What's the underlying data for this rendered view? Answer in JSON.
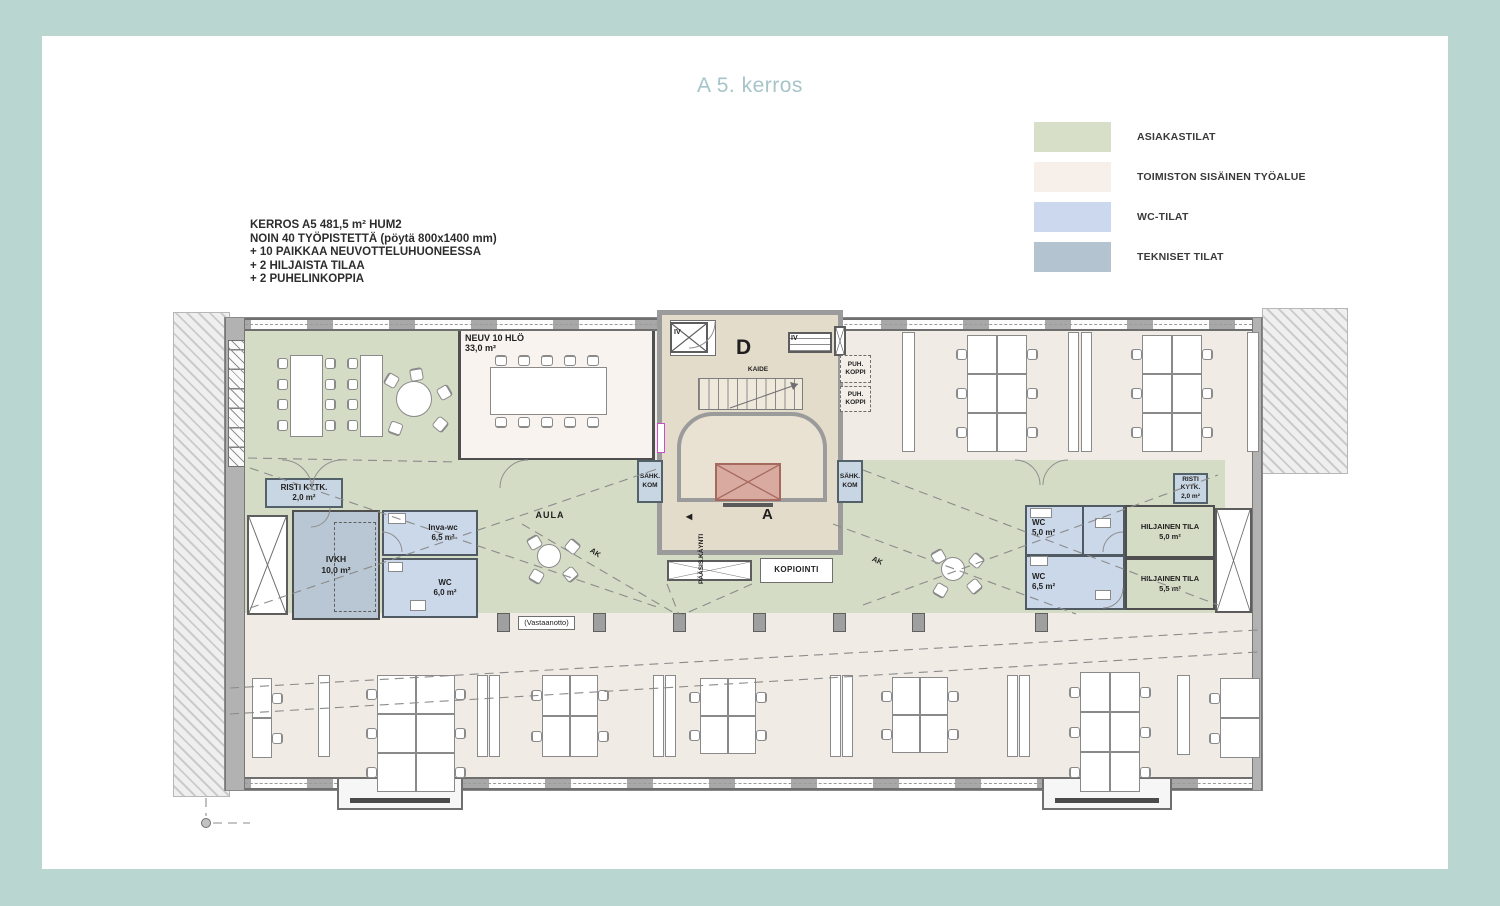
{
  "page": {
    "title": "A 5. kerros",
    "background_color": "#b9d6d0",
    "card_color": "#ffffff",
    "title_color": "#a6c4c9"
  },
  "legend": {
    "items": [
      {
        "label": "ASIAKASTILAT",
        "color": "#d7dfc9"
      },
      {
        "label": "TOIMISTON SISÄINEN TYÖALUE",
        "color": "#f7f0ea"
      },
      {
        "label": "WC-TILAT",
        "color": "#ccd8ed"
      },
      {
        "label": "TEKNISET TILAT",
        "color": "#b3c4d0"
      }
    ]
  },
  "info": {
    "lines": [
      "KERROS A5 481,5 m² HUM2",
      "NOIN 40 TYÖPISTETTÄ (pöytä 800x1400 mm)",
      "+ 10 PAIKKAA NEUVOTTELUHUONEESSA",
      "+ 2 HILJAISTA TILAA",
      "+ 2 PUHELINKOPPIA"
    ]
  },
  "plan": {
    "rooms": {
      "neuv": {
        "name": "NEUV 10 HLÖ",
        "area": "33,0 m²"
      },
      "risti_left": {
        "name": "RISTI KYTK.",
        "area": "2,0 m²"
      },
      "ivkh": {
        "name": "IVKH",
        "area": "10,0 m²"
      },
      "inva_wc": {
        "name": "Inva-wc",
        "area": "6,5 m²"
      },
      "wc_left": {
        "name": "WC",
        "area": "6,0 m²"
      },
      "wc_right_top": {
        "name": "WC",
        "area": "5,0 m²"
      },
      "wc_right_bottom": {
        "name": "WC",
        "area": "6,5 m²"
      },
      "hiljainen_top": {
        "name": "HILJAINEN TILA",
        "area": "5,0 m²"
      },
      "hiljainen_bottom": {
        "name": "HILJAINEN TILA",
        "area": "5,5 m²"
      },
      "risti_right": {
        "name": "RISTI KYTK.",
        "area": "2,0 m²"
      },
      "kopiointi": {
        "name": "KOPIOINTI"
      },
      "aula": {
        "name": "AULA"
      },
      "vastaanotto": {
        "name": "(Vastaanotto)"
      },
      "puh_koppi": {
        "name": "PUH. KOPPI"
      },
      "sahk_kom": {
        "name": "SÄHK. KOM"
      }
    },
    "labels": {
      "stair_d": "D",
      "stair_a": "A",
      "kaide": "KAIDE",
      "iv": "IV",
      "entrance": "PÄÄSIS.KÄYNTI",
      "entrance_arrow": "◀",
      "ak": "AK"
    },
    "area_colors": {
      "asiakastilat": "#d5dcc5",
      "toimisto": "#f1ebe5",
      "wc": "#cbd8e9",
      "tekniset": "#b8c7d3",
      "core": "#e3dccb",
      "elevator": "#d9aaa0"
    }
  }
}
